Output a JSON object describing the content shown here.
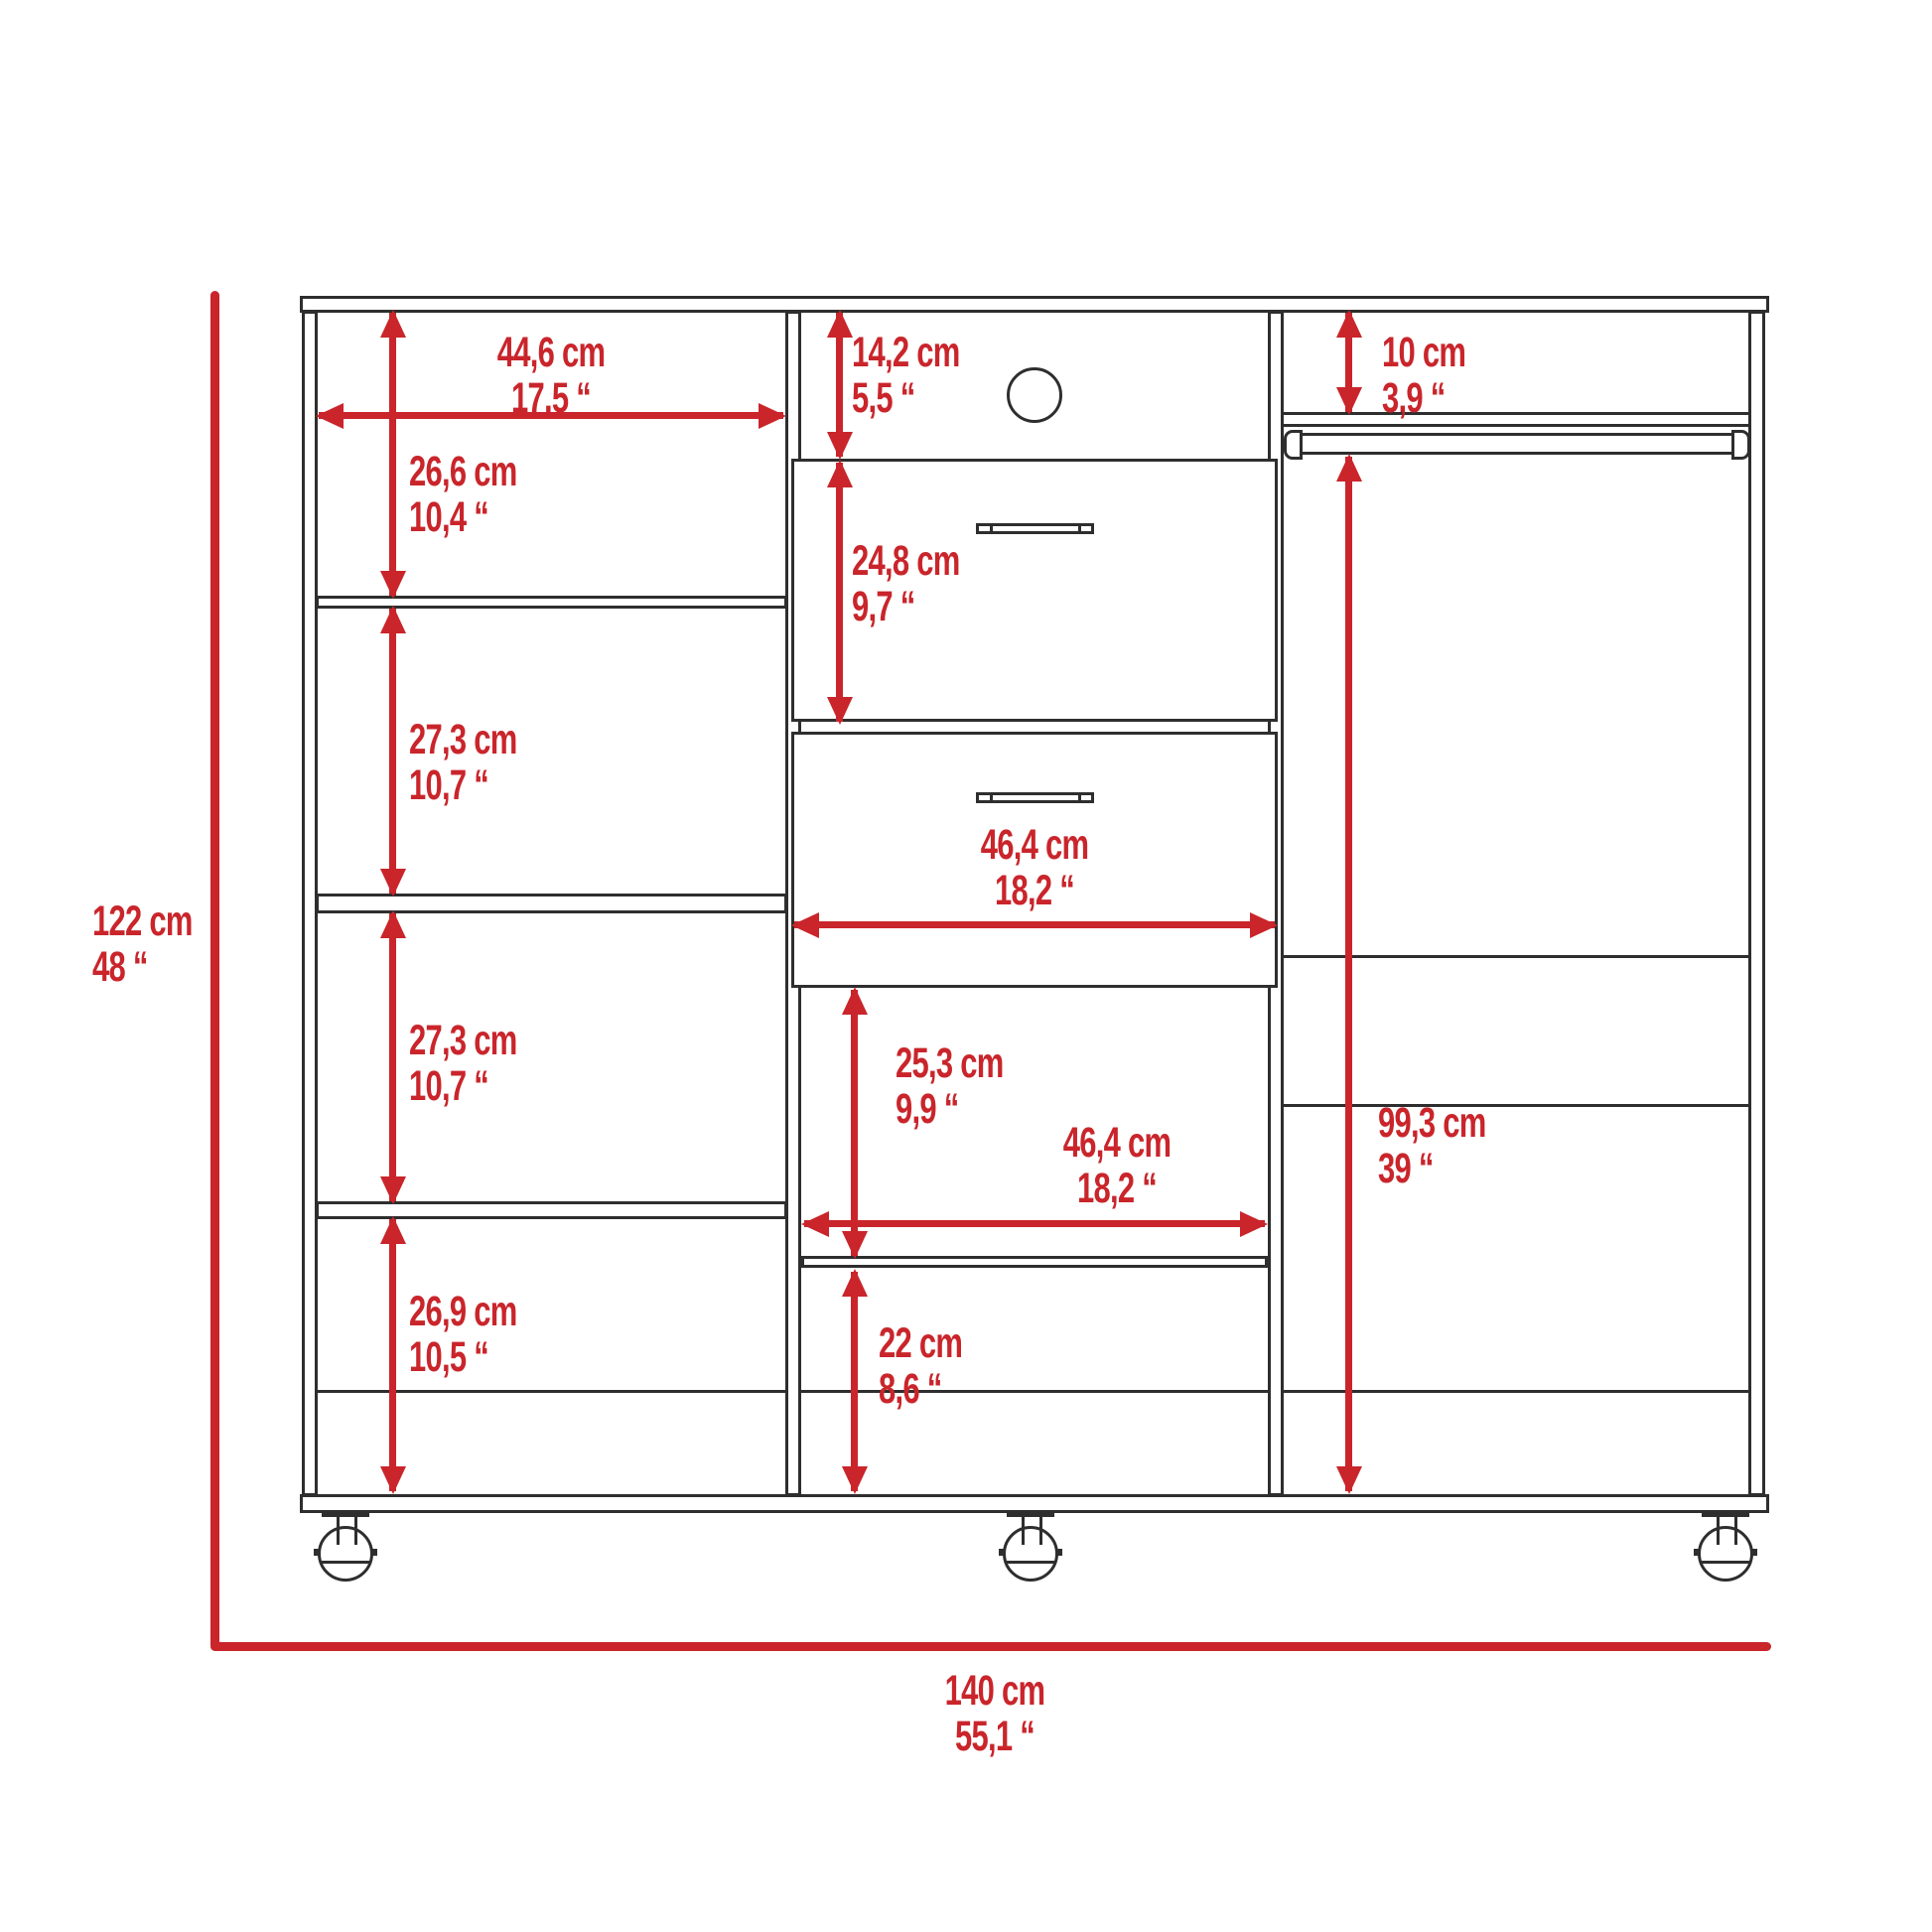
{
  "diagram": {
    "type": "furniture-dimension-drawing",
    "colors": {
      "dimension_red": "#c9252b",
      "line_black": "#2e2e2e",
      "background": "#ffffff"
    },
    "dimensions": {
      "left_column_width": {
        "cm": "44,6 cm",
        "in": "17,5 “"
      },
      "left_shelf_1_height": {
        "cm": "26,6 cm",
        "in": "10,4 “"
      },
      "left_shelf_2_height": {
        "cm": "27,3 cm",
        "in": "10,7 “"
      },
      "left_shelf_3_height": {
        "cm": "27,3 cm",
        "in": "10,7 “"
      },
      "left_shelf_4_height": {
        "cm": "26,9 cm",
        "in": "10,5 “"
      },
      "top_cubby_height": {
        "cm": "14,2 cm",
        "in": "5,5 “"
      },
      "drawer_height": {
        "cm": "24,8 cm",
        "in": "9,7 “"
      },
      "drawer_width": {
        "cm": "46,4 cm",
        "in": "18,2 “"
      },
      "middle_open_height": {
        "cm": "25,3 cm",
        "in": "9,9 “"
      },
      "middle_open_width": {
        "cm": "46,4 cm",
        "in": "18,2 “"
      },
      "bottom_cubby_height": {
        "cm": "22 cm",
        "in": "8,6 “"
      },
      "rod_clearance": {
        "cm": "10 cm",
        "in": "3,9 “"
      },
      "hanging_height": {
        "cm": "99,3 cm",
        "in": "39 “"
      },
      "total_height": {
        "cm": "122 cm",
        "in": "48 “"
      },
      "total_width": {
        "cm": "140 cm",
        "in": "55,1 “"
      }
    }
  }
}
